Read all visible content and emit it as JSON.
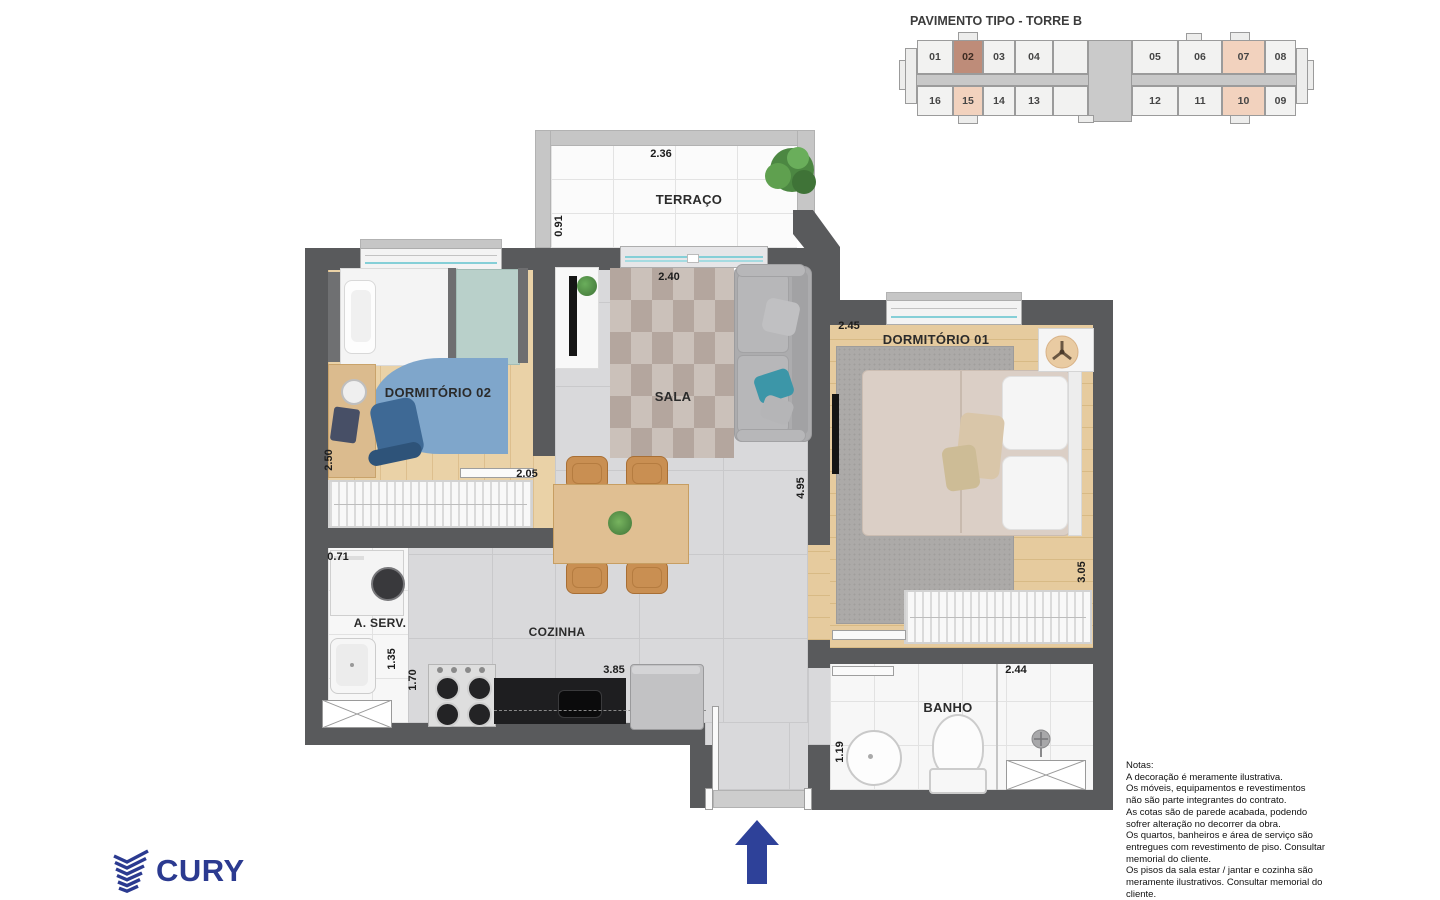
{
  "header": {
    "title": "PAVIMENTO TIPO - TORRE B"
  },
  "keyplan": {
    "cells": [
      "01",
      "02",
      "03",
      "04",
      "05",
      "06",
      "07",
      "08",
      "16",
      "15",
      "14",
      "13",
      "12",
      "11",
      "10",
      "09"
    ],
    "selected_unit": "02",
    "highlighted_units": [
      "07",
      "15",
      "10"
    ]
  },
  "rooms": {
    "terraco": {
      "name": "TERRAÇO",
      "width": "2.36",
      "depth": "0.91"
    },
    "sala": {
      "name": "SALA",
      "width": "2.40",
      "depth": "4.95"
    },
    "dormitorio02": {
      "name": "DORMITÓRIO 02",
      "width": "2.05",
      "depth": "2.50"
    },
    "dormitorio01": {
      "name": "DORMITÓRIO 01",
      "width": "2.45",
      "depth": "3.05"
    },
    "area_servico": {
      "name": "A. SERV.",
      "width": "0.71",
      "depth": "1.35"
    },
    "cozinha": {
      "name": "COZINHA",
      "width": "3.85",
      "depth": "1.70"
    },
    "banho": {
      "name": "BANHO",
      "width": "2.44",
      "depth": "1.19"
    }
  },
  "notes": {
    "heading": "Notas:",
    "lines": [
      "A decoração é meramente ilustrativa.",
      "Os móveis, equipamentos e revestimentos",
      "não são parte integrantes do contrato.",
      "As cotas são de parede acabada, podendo",
      "sofrer alteração no decorrer da obra.",
      "Os quartos, banheiros e área de serviço são",
      "entregues com revestimento de piso. Consultar",
      "memorial do cliente.",
      "Os pisos da sala estar / jantar e cozinha são",
      "meramente ilustrativos. Consultar memorial do",
      "cliente."
    ]
  },
  "brand": {
    "name": "CURY"
  },
  "colors": {
    "brand_blue": "#2B3A90",
    "arrow_blue": "#2E4199",
    "wall": "#595A5C",
    "keyplan_selected": "#BE8C79",
    "keyplan_highlight": "#F2D2BE"
  }
}
